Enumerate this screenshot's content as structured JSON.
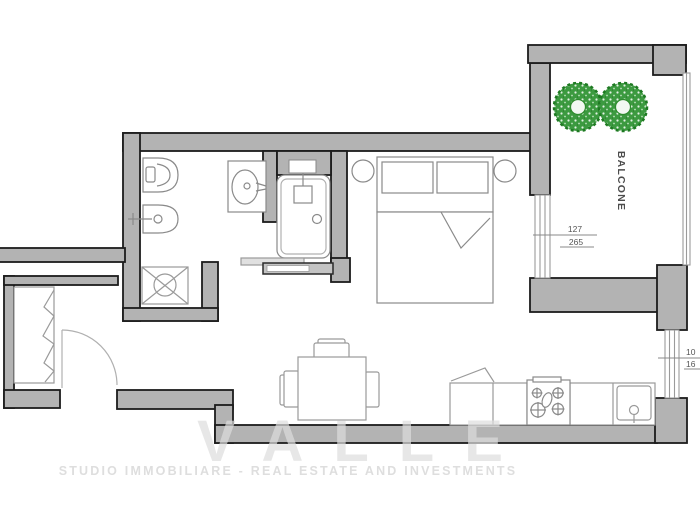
{
  "plan": {
    "type": "apartment-floor-plan",
    "rooms": {
      "balcony_label": "BALCONE"
    },
    "dimensions": {
      "balcony_window": {
        "top": "127",
        "bottom": "265"
      },
      "kitchen_window": {
        "top": "10",
        "bottom": "16"
      }
    },
    "watermark": {
      "brand": "VALLE",
      "tagline": "STUDIO IMMOBILIARE - REAL ESTATE AND INVESTMENTS"
    },
    "fixtures": [
      "toilet-icon",
      "bidet-icon",
      "washbasin-icon",
      "bathtub-icon",
      "shower-tray-icon",
      "sliding-door-icon",
      "wardrobe-icon",
      "entry-door-arc-icon",
      "double-bed-icon",
      "pillow-icon",
      "nightstand-icon",
      "dining-table-icon",
      "chair-icon",
      "cooktop-icon",
      "kitchen-sink-icon",
      "tree-icon",
      "window-icon"
    ],
    "colors": {
      "wall_fill": "#b3b3b3",
      "wall_outline": "#1c1c1c",
      "fixture_stroke": "#8a8a8a",
      "window_stroke": "#9a9a9a",
      "tree_green": "#3c9a40",
      "tree_ring": "#1e7a22",
      "dimension_text": "#555555",
      "watermark_gray": "#dedede",
      "background": "#ffffff"
    }
  }
}
